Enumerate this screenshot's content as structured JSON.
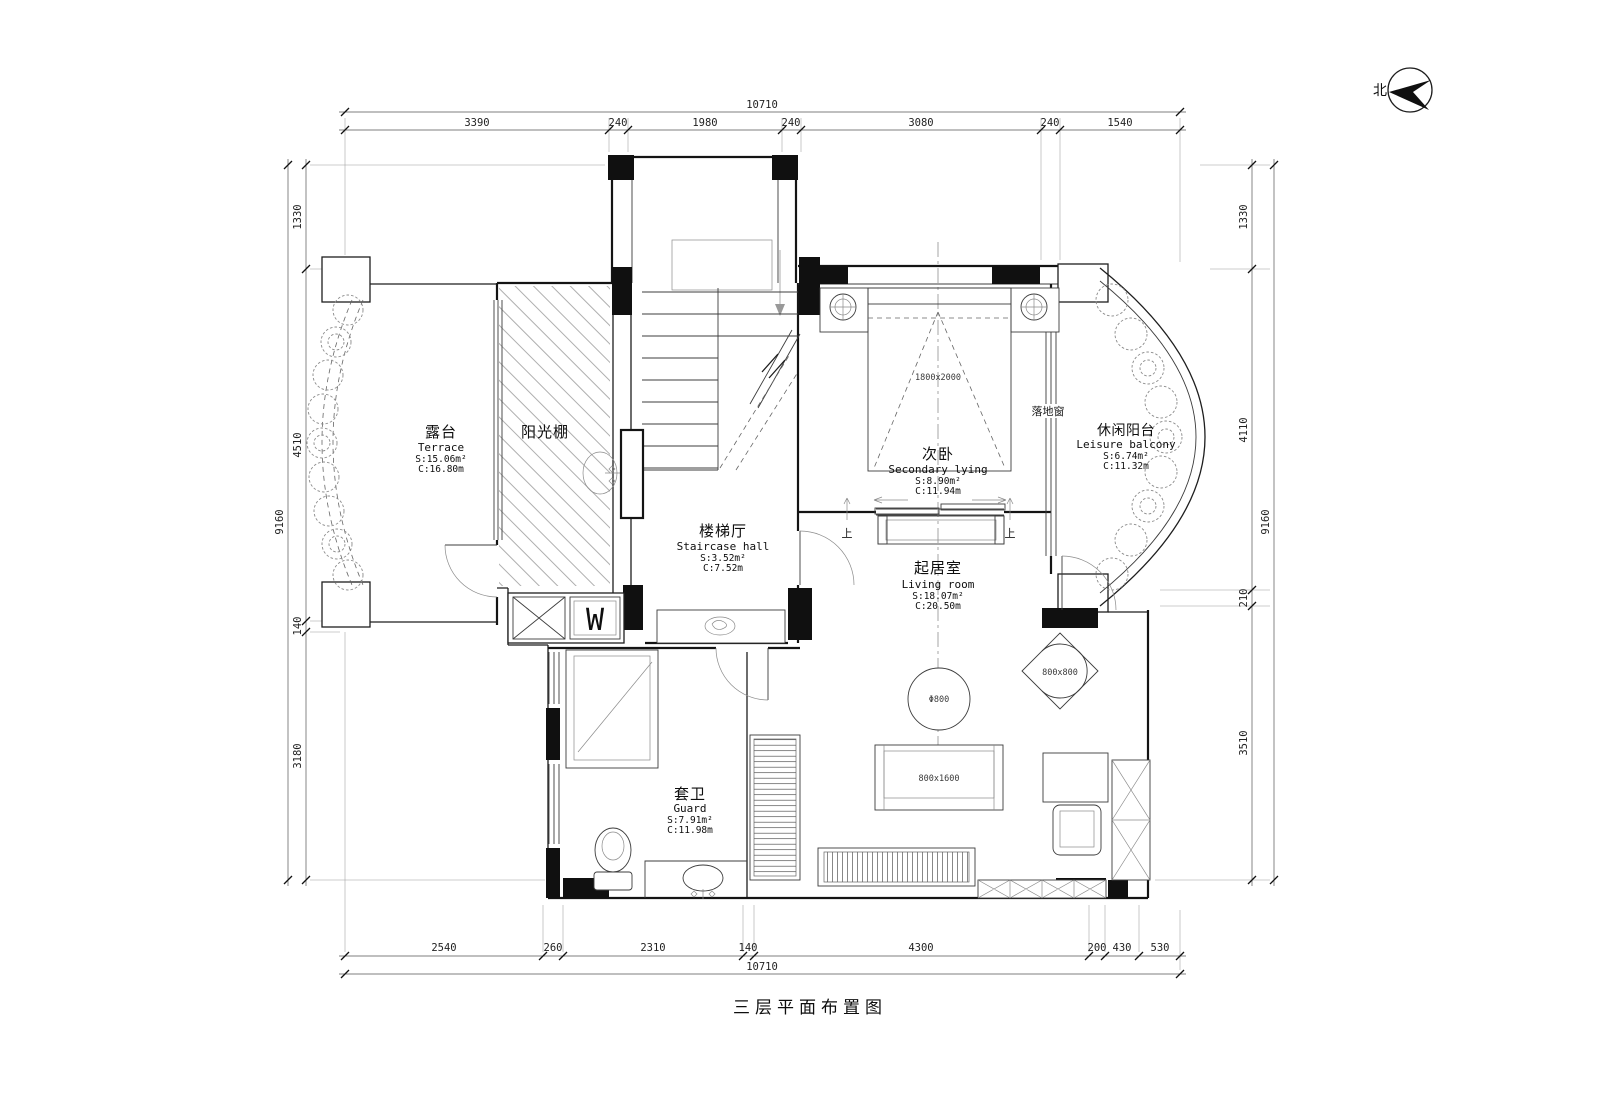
{
  "meta": {
    "title": "三层平面布置图",
    "north_label": "北"
  },
  "dimensions": {
    "top": {
      "total": "10710",
      "segments": [
        "3390",
        "240",
        "1980",
        "240",
        "3080",
        "240",
        "1540"
      ]
    },
    "bottom": {
      "total": "10710",
      "segments": [
        "2540",
        "260",
        "2310",
        "140",
        "4300",
        "200",
        "430",
        "530"
      ]
    },
    "left": {
      "total": "9160",
      "segments": [
        "1330",
        "4510",
        "140",
        "3180"
      ]
    },
    "right": {
      "total": "9160",
      "segments": [
        "1330",
        "4110",
        "210",
        "3510"
      ]
    }
  },
  "rooms": {
    "terrace": {
      "name_cn": "露台",
      "name_en": "Terrace",
      "area": "S:15.06m²",
      "c": "C:16.80m"
    },
    "sunroom": {
      "name_cn": "阳光棚"
    },
    "secondary_bedroom": {
      "name_cn": "次卧",
      "name_en": "Secondary lying",
      "area": "S:8.90m²",
      "c": "C:11.94m"
    },
    "leisure_balcony": {
      "name_cn": "休闲阳台",
      "name_en": "Leisure balcony",
      "area": "S:6.74m²",
      "c": "C:11.32m"
    },
    "staircase_hall": {
      "name_cn": "楼梯厅",
      "name_en": "Staircase hall",
      "area": "S:3.52m²",
      "c": "C:7.52m"
    },
    "living_room": {
      "name_cn": "起居室",
      "name_en": "Living room",
      "area": "S:18.07m²",
      "c": "C:20.50m"
    },
    "guard_bathroom": {
      "name_cn": "套卫",
      "name_en": "Guard",
      "area": "S:7.91m²",
      "c": "C:11.98m"
    }
  },
  "annotations": {
    "floor_window": "落地窗",
    "up_left": "上",
    "up_right": "上",
    "washing_machine": "W",
    "bed_size": "1800x2000",
    "round_table_size": "Φ800",
    "coffee_table_size": "800x1600",
    "corner_chair_size": "800x800"
  },
  "colors": {
    "wall": "#141414",
    "paper": "#ffffff",
    "annotation": "#3a3a3a"
  }
}
